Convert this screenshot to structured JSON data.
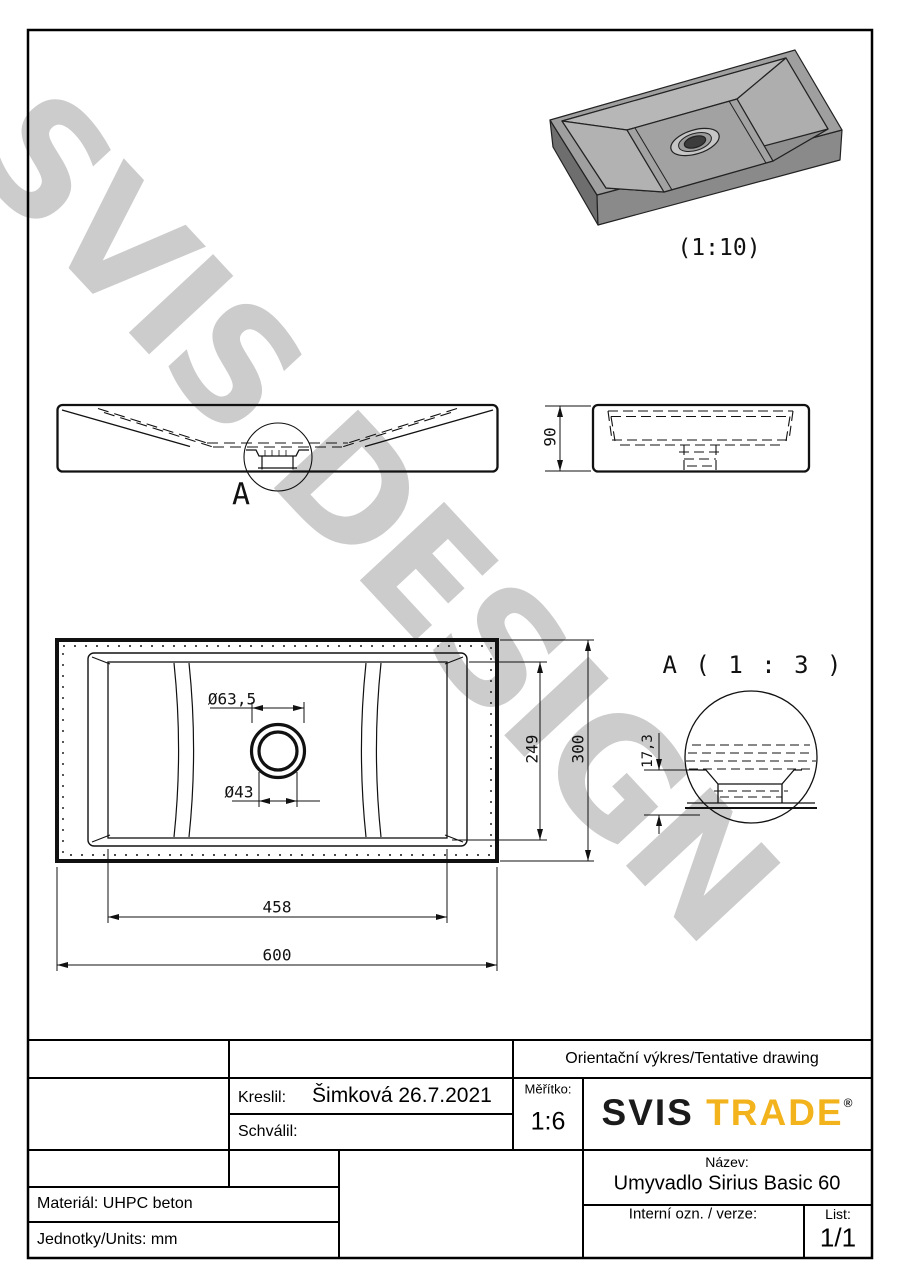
{
  "watermark": {
    "text": "SVIS DESIGN"
  },
  "drawing": {
    "iso_scale_label": "(1:10)",
    "detail_marker": "A",
    "detail_title": "A ( 1 : 3 )",
    "dims": {
      "height": "90",
      "drain_outer_dia": "Ø63,5",
      "drain_hole_dia": "Ø43",
      "basin_width": "249",
      "overall_width": "300",
      "basin_length": "458",
      "overall_length": "600",
      "drain_recess_depth": "17,3"
    }
  },
  "title_block": {
    "tentative": "Orientační výkres/Tentative drawing",
    "kreslil_label": "Kreslil:",
    "kreslil_value": "Šimková 26.7.2021",
    "schvalil_label": "Schválil:",
    "meritko_label": "Měřítko:",
    "meritko_value": "1:6",
    "logo": {
      "part1": "SVIS",
      "part2": "TRADE",
      "reg": "®"
    },
    "nazev_label": "Název:",
    "nazev_value": "Umyvadlo Sirius Basic 60",
    "interni_label": "Interní ozn. / verze:",
    "list_label": "List:",
    "list_value": "1/1",
    "material": "Materiál: UHPC beton",
    "units": "Jednotky/Units: mm"
  },
  "colors": {
    "line": "#111111",
    "logo_accent": "#f2b31c",
    "watermark": "#cccccc"
  }
}
